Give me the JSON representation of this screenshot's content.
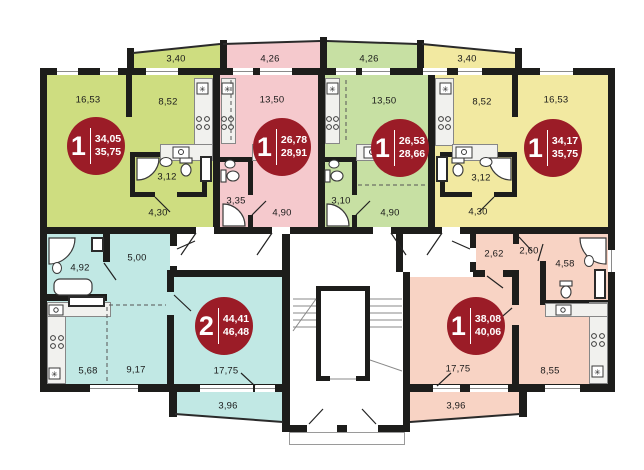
{
  "floorplan": {
    "colors": {
      "wall": "#1d1d1b",
      "badge": "#9b1c27",
      "apt_top_left": "#cedd80",
      "apt_top_mid_left": "#f5c9cd",
      "apt_top_mid_right": "#c7e0a3",
      "apt_top_right": "#f2e9a1",
      "apt_bottom_left": "#c1e8e4",
      "apt_bottom_right": "#f8d3c4"
    },
    "apartments": [
      {
        "name": "apartment-top-left",
        "room_count": "1",
        "area_main": "34,05",
        "area_total": "35,75",
        "balcony_area": "3,40",
        "rooms": [
          {
            "name": "living-room",
            "area": "16,53"
          },
          {
            "name": "kitchen",
            "area": "8,52"
          },
          {
            "name": "bathroom",
            "area": "3,12"
          },
          {
            "name": "hallway",
            "area": "4,30"
          }
        ]
      },
      {
        "name": "apartment-top-mid-left",
        "room_count": "1",
        "area_main": "26,78",
        "area_total": "28,91",
        "balcony_area": "4,26",
        "rooms": [
          {
            "name": "studio-room",
            "area": "13,50"
          },
          {
            "name": "bathroom",
            "area": "3,35"
          },
          {
            "name": "hallway",
            "area": "4,90"
          }
        ]
      },
      {
        "name": "apartment-top-mid-right",
        "room_count": "1",
        "area_main": "26,53",
        "area_total": "28,66",
        "balcony_area": "4,26",
        "rooms": [
          {
            "name": "studio-room",
            "area": "13,50"
          },
          {
            "name": "bathroom",
            "area": "3,10"
          },
          {
            "name": "hallway",
            "area": "4,90"
          }
        ]
      },
      {
        "name": "apartment-top-right",
        "room_count": "1",
        "area_main": "34,17",
        "area_total": "35,75",
        "balcony_area": "3,40",
        "rooms": [
          {
            "name": "kitchen",
            "area": "8,52"
          },
          {
            "name": "living-room",
            "area": "16,53"
          },
          {
            "name": "bathroom",
            "area": "3,12"
          },
          {
            "name": "hallway",
            "area": "4,30"
          }
        ]
      },
      {
        "name": "apartment-bottom-left",
        "room_count": "2",
        "area_main": "44,41",
        "area_total": "46,48",
        "balcony_area": "3,96",
        "rooms": [
          {
            "name": "bathroom",
            "area": "4,92"
          },
          {
            "name": "hallway",
            "area": "5,00"
          },
          {
            "name": "kitchen",
            "area": "5,68"
          },
          {
            "name": "room",
            "area": "9,17"
          },
          {
            "name": "living-room",
            "area": "17,75"
          }
        ]
      },
      {
        "name": "apartment-bottom-right",
        "room_count": "1",
        "area_main": "38,08",
        "area_total": "40,06",
        "balcony_area": "3,96",
        "rooms": [
          {
            "name": "entry",
            "area": "2,62"
          },
          {
            "name": "entry-2",
            "area": "2,60"
          },
          {
            "name": "bathroom",
            "area": "4,58"
          },
          {
            "name": "living-room",
            "area": "17,75"
          },
          {
            "name": "kitchen",
            "area": "8,55"
          }
        ]
      }
    ]
  }
}
